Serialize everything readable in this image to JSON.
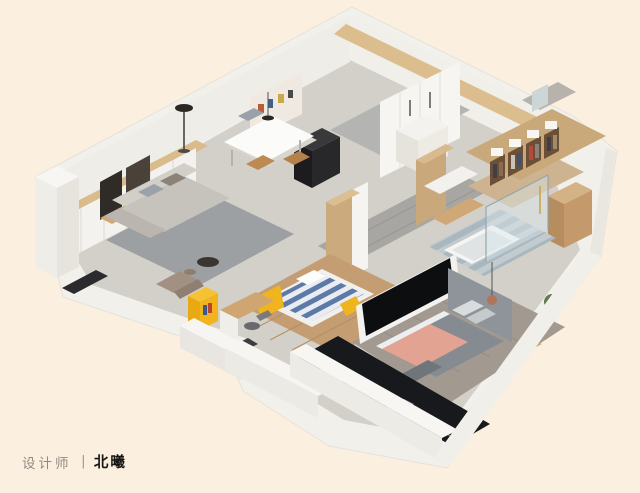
{
  "caption": {
    "role": "设计师",
    "separator": "|",
    "name": "北曦"
  },
  "palette": {
    "background": "#fbf0e0",
    "platform_white": "#f2f0eb",
    "wall_white": "#f6f5f1",
    "floor_gray": "#d3d0ca",
    "wood_oak": "#c9a87c",
    "wood_warm": "#cfa875",
    "rug_gray": "#9ca0a3",
    "accent_yellow": "#f0b41e",
    "stripe_blue": "#5d79a6",
    "blanket_pink": "#e3a392",
    "duvet_gray": "#868b91",
    "marble_black": "#17191d",
    "bath_tile": "#aab8bf"
  },
  "scene": {
    "type": "isometric-apartment-render",
    "rooms": [
      "living-room",
      "dining-area",
      "kitchen",
      "hallway",
      "kids-bedroom",
      "study-nook",
      "bathroom",
      "walk-in-closet",
      "master-bedroom",
      "balcony"
    ]
  }
}
